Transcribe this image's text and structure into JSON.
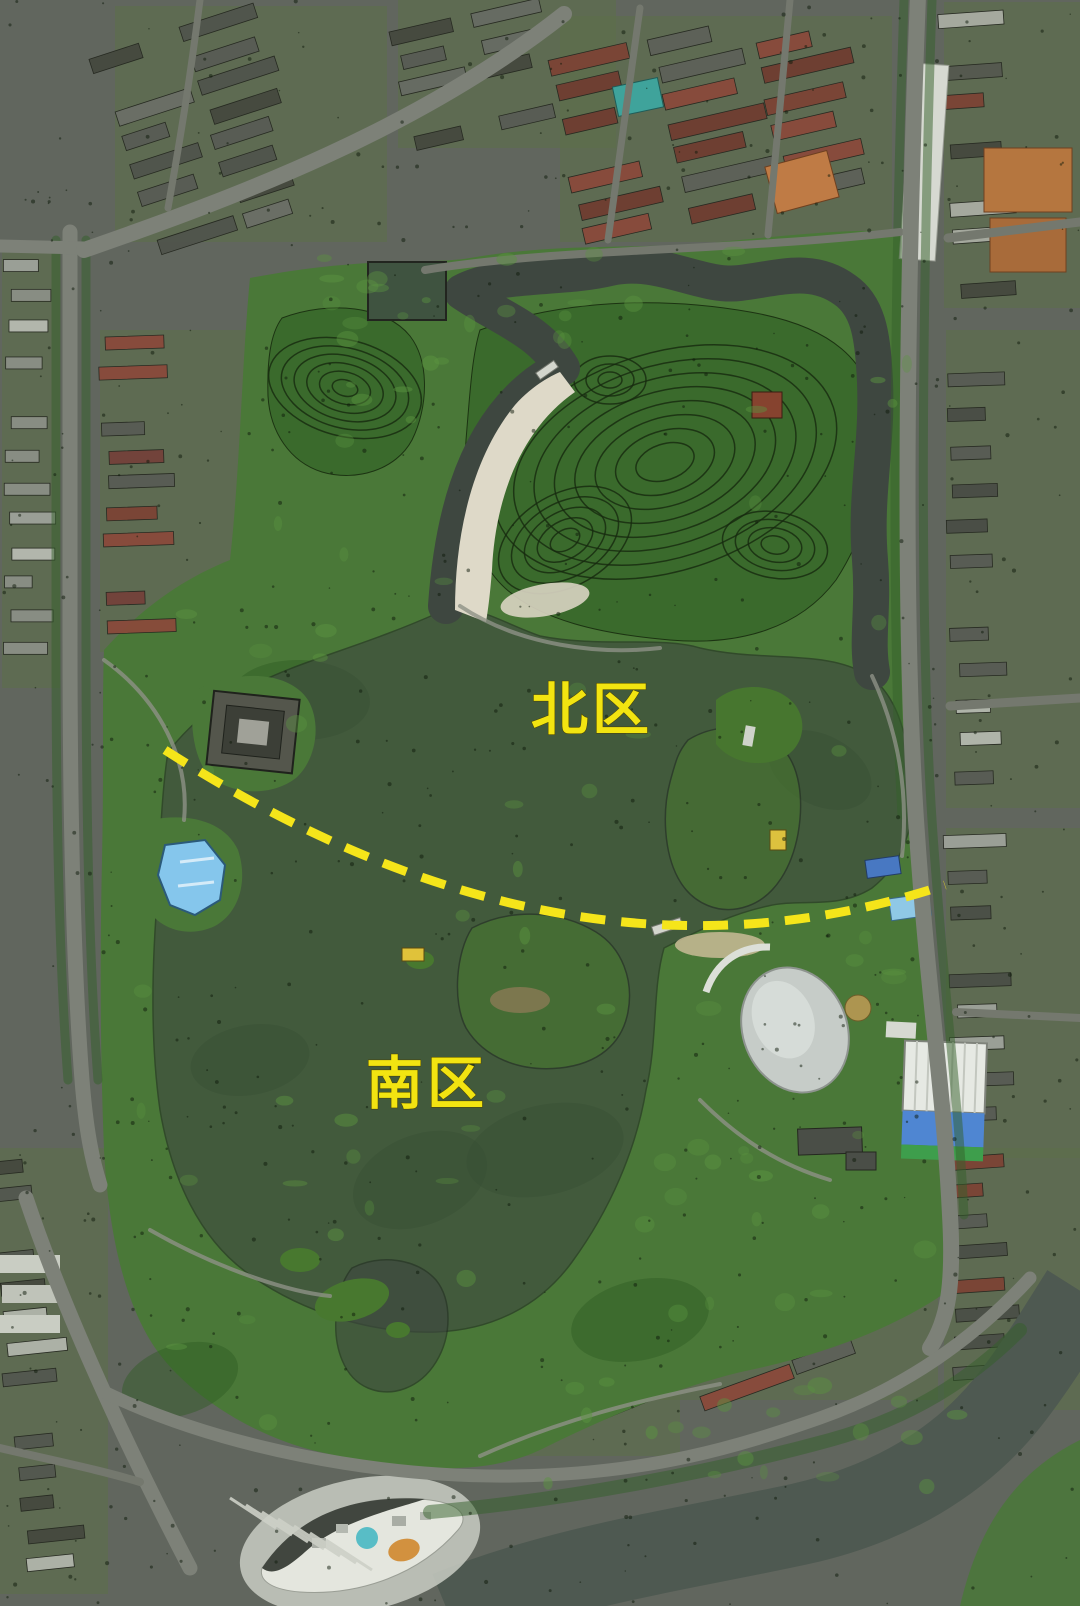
{
  "map": {
    "description": "Annotated satellite view of a lake park divided into a north zone and a south zone by a dashed boundary line",
    "labels": {
      "color": "#f2e411",
      "north": {
        "text": "北区"
      },
      "south": {
        "text": "南区"
      }
    },
    "divider": {
      "color": "#f5e51a",
      "style": "dashed"
    },
    "features": [
      "north-lake",
      "south-lake",
      "north-hill",
      "west-hill",
      "beach",
      "swimming-pool",
      "dome-building",
      "blue-roof-building",
      "temple-complex",
      "crescent-building",
      "river",
      "east-peninsula",
      "center-island",
      "zone-divider-line"
    ],
    "palette": {
      "base": "#61665e",
      "water": "#3e4740",
      "river": "#4e5951",
      "park": "#4a7838",
      "hill": "#3a6a2c",
      "contour": "#17290f",
      "beach": "#ded9c8",
      "road": "#7d8178",
      "path": "#8d9186",
      "tree_line": "#33602a",
      "urban_green": "#5c7049",
      "building_gray": "#585c55",
      "building_dark": "#45493f",
      "building_light": "#b7bbb1",
      "roof_red": "#7c4335",
      "roof_orange": "#bf7b45",
      "pool_blue": "#85c6ec",
      "roof_blue": "#4f86d2",
      "dome_white": "#c6ccc8",
      "teal": "#58bdc6",
      "accent_yellow": "#e0c23a"
    }
  }
}
